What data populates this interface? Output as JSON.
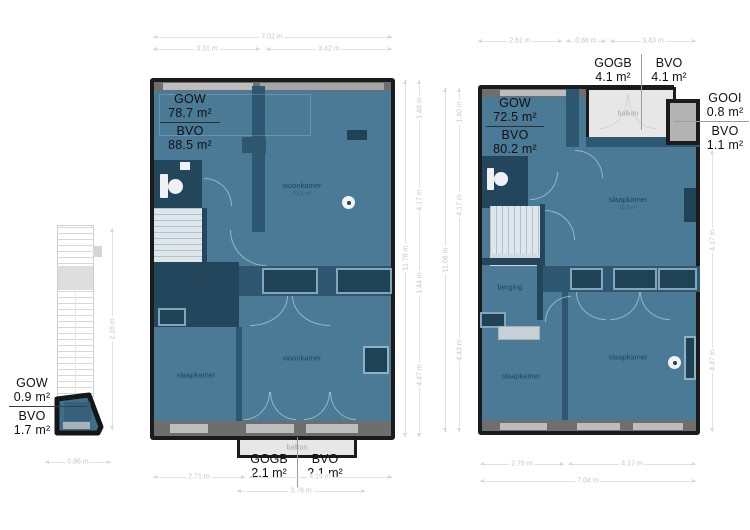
{
  "colors": {
    "room_fill": "#4a7a96",
    "inner_wall": "#2e5871",
    "inner_wall_dark": "#24465c",
    "outer_wall": "#1b1b1b",
    "window_gray": "#bdbdbd",
    "balcony_fill": "#e7e7e7",
    "dim_text": "#c6c6c6",
    "area_label_text": "#111111",
    "room_label_text": "#173c52"
  },
  "stair_unit": {
    "gow_label": "GOW",
    "gow_value": "0.9 m²",
    "bvo_label": "BVO",
    "bvo_value": "1.7 m²",
    "dim_width": "0.86 m",
    "dim_height": "2.16 m"
  },
  "floor1": {
    "gow_label": "GOW",
    "gow_value": "78.7 m²",
    "bvo_label": "BVO",
    "bvo_value": "88.5 m²",
    "rooms": {
      "living_top": "woonkamer",
      "living_top_sub": "41.5 m²",
      "bedroom": "slaapkamer",
      "living_bottom": "woonkamer"
    },
    "balcony": {
      "label": "balkon",
      "gogb_label": "GOGB",
      "gogb_value": "2.1 m²",
      "bvo_label": "BVO",
      "bvo_value": "2.1 m²"
    },
    "dims": {
      "top_total": "7.02 m",
      "top_left": "3.31 m",
      "top_right": "3.42 m",
      "bottom_left": "2.71 m",
      "bottom_right": "4.19 m",
      "bottom_center": "3.78 m",
      "right_total": "11.78 m",
      "right_seg1": "1.48 m",
      "right_seg2": "4.17 m",
      "right_seg3": "1.44 m",
      "right_seg4": "4.47 m"
    }
  },
  "floor2": {
    "gow_label": "GOW",
    "gow_value": "72.5 m²",
    "bvo_label": "BVO",
    "bvo_value": "80.2 m²",
    "rooms": {
      "bedroom_top": "slaapkamer",
      "bedroom_top_sub": "16.9 m²",
      "storage": "berging",
      "bedroom_left": "slaapkamer",
      "bedroom_right": "slaapkamer"
    },
    "balcony": {
      "label": "balkon",
      "gogb_label": "GOGB",
      "gogb_value": "4.1 m²",
      "bvo_label": "BVO",
      "bvo_value": "4.1 m²"
    },
    "gooi": {
      "label": "GOOI",
      "value": "0.8 m²",
      "bvo_label": "BVO",
      "bvo_value": "1.1 m²"
    },
    "dims": {
      "top_left": "2.61 m",
      "top_mid": "0.88 m",
      "top_right": "3.43 m",
      "bottom_left": "2.76 m",
      "bottom_right": "4.17 m",
      "bottom_total": "7.04 m",
      "left_total": "11.08 m",
      "left_seg1": "1.40 m",
      "left_seg2": "4.17 m",
      "left_seg3": "4.43 m",
      "right_seg1": "4.17 m",
      "right_seg2": "4.47 m"
    }
  }
}
